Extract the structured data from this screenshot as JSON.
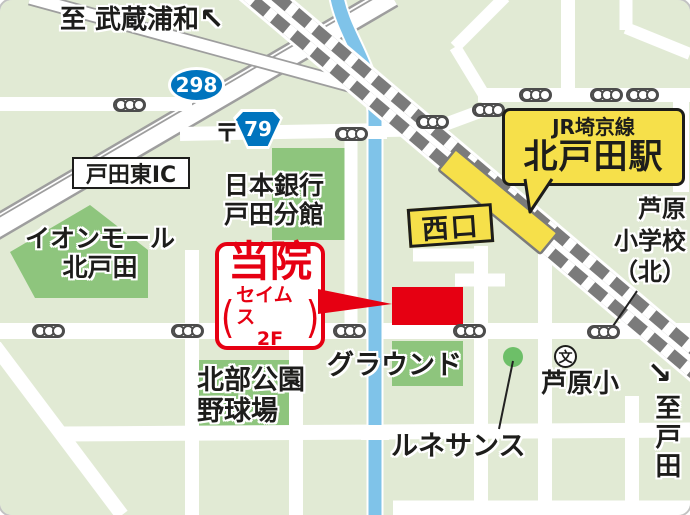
{
  "colors": {
    "bg": "#e1ead4",
    "block": "#8ec57d",
    "dot": "#6dbf68",
    "river": "#7fc3e9",
    "rail": "#7b7b7b",
    "edge": "#9e9e9e",
    "red": "#e60012",
    "yellow": "#f6e04a",
    "blue": "#0074be",
    "ink": "#1d1d1b"
  },
  "destinations": {
    "north": "至 武蔵浦和",
    "north_arrow": "↖",
    "south": "至戸田",
    "south_arrow": "↘"
  },
  "routes": {
    "national": "298",
    "prefectural": "79"
  },
  "symbols": {
    "postal": "〒",
    "school": "文"
  },
  "station": {
    "line": "JR埼京線",
    "name": "北戸田駅",
    "exit": "西口"
  },
  "clinic": {
    "title": "当院",
    "building": "セイムス",
    "floor": "2F",
    "paren_open": "(",
    "paren_close": ")"
  },
  "places": {
    "interchange": "戸田東IC",
    "bank_l1": "日本銀行",
    "bank_l2": "戸田分館",
    "mall_l1": "イオンモール",
    "mall_l2": "北戸田",
    "park_l1": "北部公園",
    "park_l2": "野球場",
    "ground": "グラウンド",
    "renaissance": "ルネサンス",
    "school_small": "芦原小",
    "school_north_l1": "芦原",
    "school_north_l2": "小学校",
    "school_north_l3": "（北）"
  }
}
